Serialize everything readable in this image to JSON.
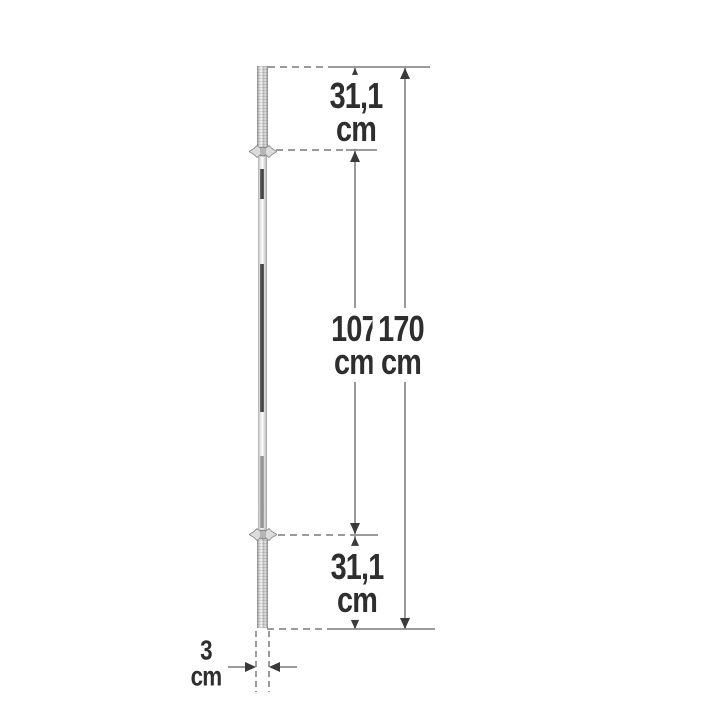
{
  "diagram": {
    "name": "barbell-bar-dimension-diagram",
    "dimensions": {
      "top_sleeve": {
        "value": "31,1",
        "unit": "cm"
      },
      "shaft": {
        "value": "107",
        "unit": "cm"
      },
      "total_length": {
        "value": "170",
        "unit": "cm"
      },
      "bottom_sleeve": {
        "value": "31,1",
        "unit": "cm"
      },
      "bar_diameter": {
        "value": "3",
        "unit": "cm"
      }
    },
    "colors": {
      "background": "#ffffff",
      "dimension_line": "#9a9a9a",
      "arrowhead": "#3a3a3a",
      "label_text": "#2e2e2e",
      "bar_chrome_light": "#f6f6f6",
      "bar_knurl_dark": "#3c3c3c"
    }
  }
}
